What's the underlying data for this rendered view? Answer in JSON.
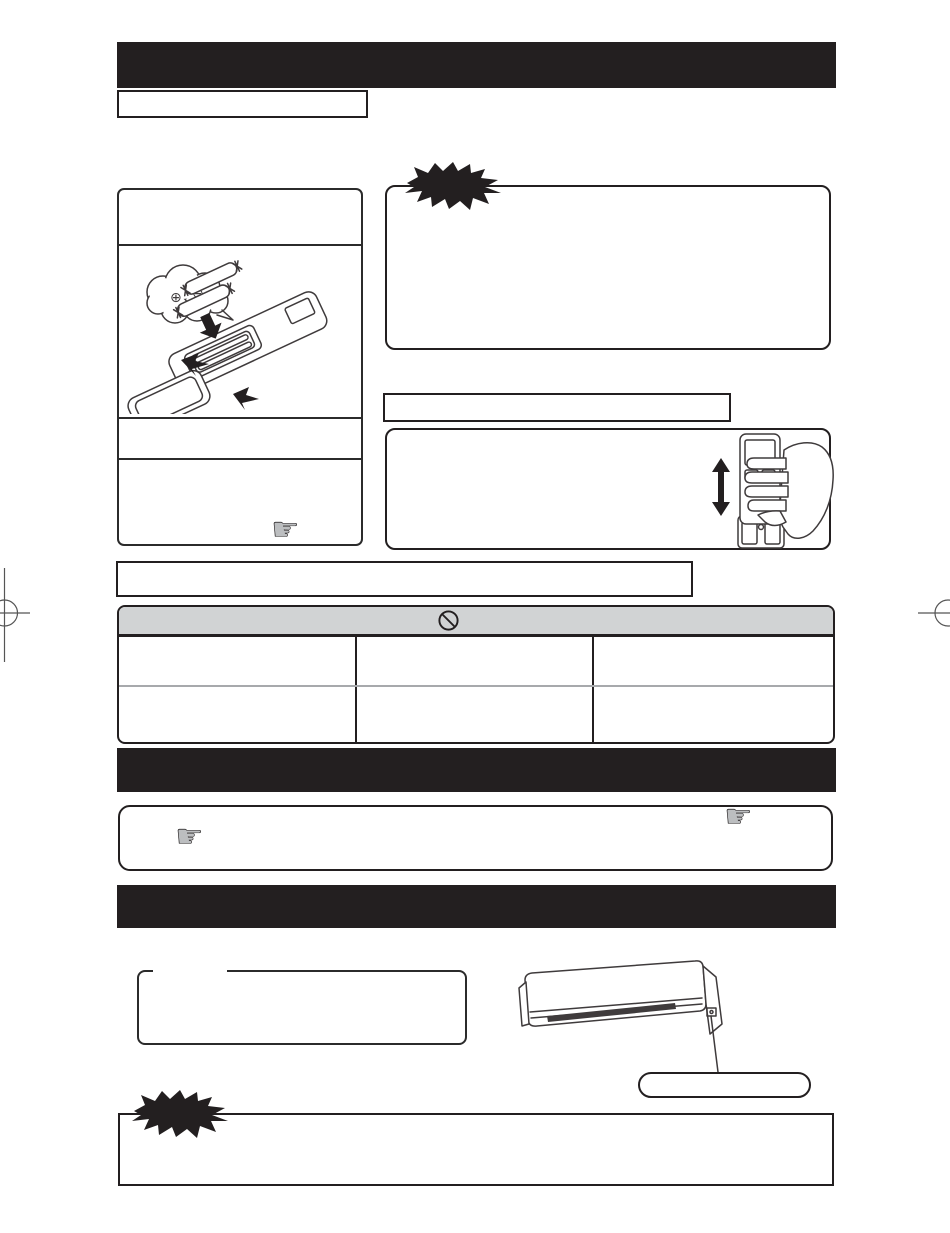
{
  "document": {
    "kind": "appliance-manual-scanned-page",
    "background": "#ffffff"
  },
  "colors": {
    "ink": "#231f20",
    "table_header_fill": "#d1d3d4",
    "table_row_divider": "#a7a9ac",
    "hand_icon_fill": "#bcbec0",
    "illustration_stroke": "#3f3b3c"
  },
  "glyphs": {
    "pointing_hand_outline": "☞",
    "pointing_hand_fill": "☛",
    "battery_plus": "⊕",
    "battery_minus": "⊖"
  },
  "sections": {
    "title_bar": {
      "label": ""
    },
    "subtitle_box": {
      "label": ""
    },
    "battery_panel": {
      "label": "",
      "segments": 4
    },
    "caution_box": {
      "label": ""
    },
    "holder_heading_box": {
      "label": ""
    },
    "holder_box": {
      "label": ""
    },
    "note_box": {
      "label": ""
    },
    "prohibition_table": {
      "columns": 3,
      "rows": 2,
      "header_icon": "prohibition-sign"
    },
    "section_bar_middle": {
      "label": ""
    },
    "tips_box": {
      "label": ""
    },
    "section_bar_bottom": {
      "label": ""
    },
    "fieldset_box": {
      "label": ""
    },
    "indoor_unit_callout_pill": {
      "label": ""
    },
    "warning_box": {
      "label": ""
    }
  }
}
